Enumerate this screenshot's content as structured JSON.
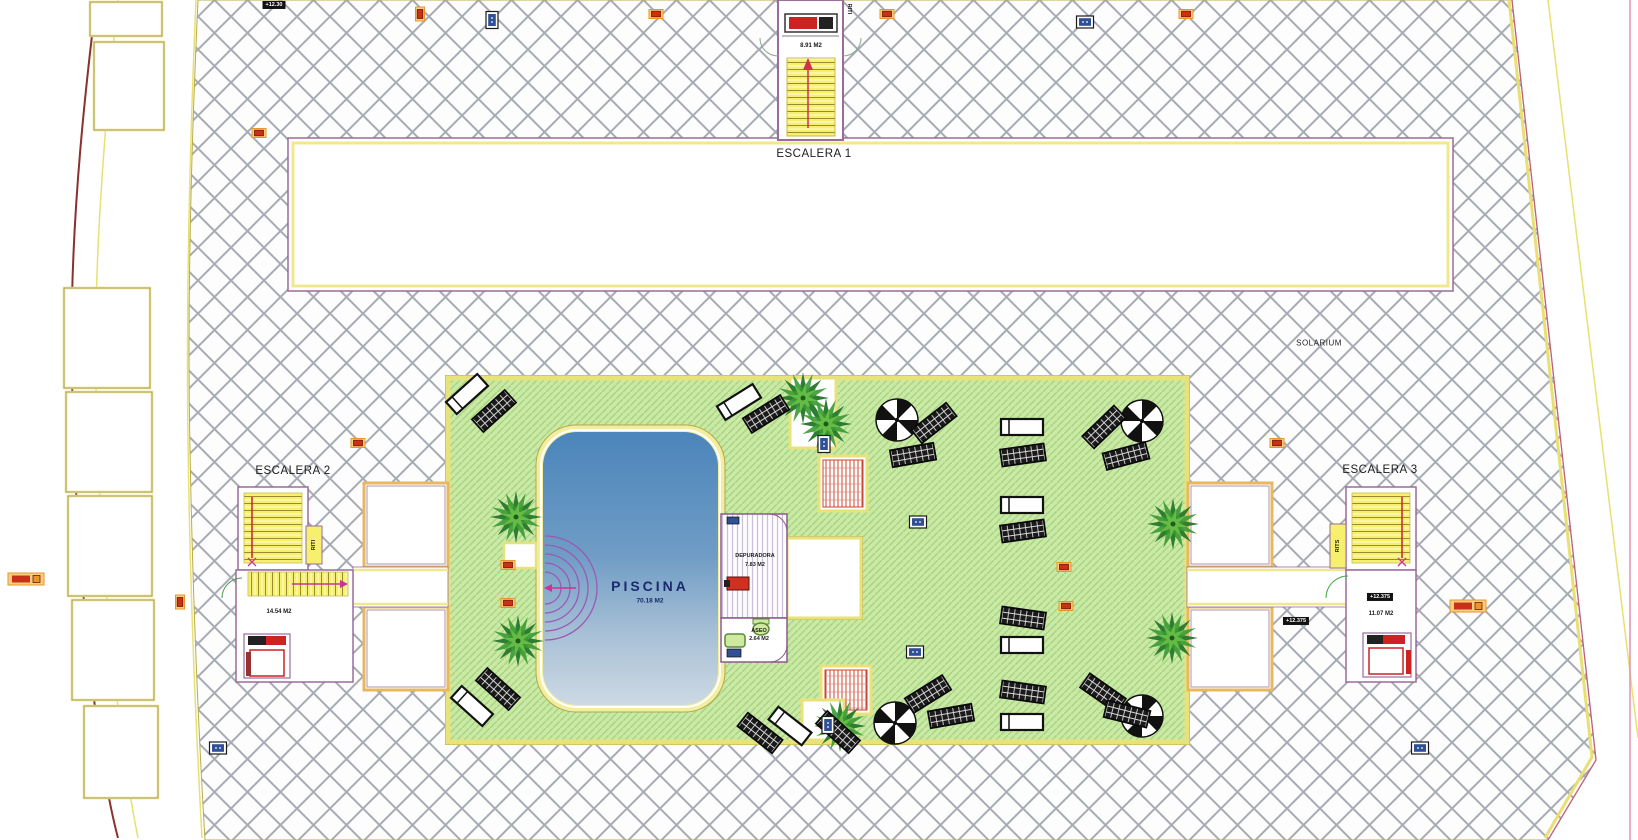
{
  "plan": {
    "rooms": {
      "escalera1": {
        "name": "ESCALERA 1",
        "area": "8.91 M2"
      },
      "escalera2": {
        "name": "ESCALERA 2",
        "area": "14.54 M2"
      },
      "escalera3": {
        "name": "ESCALERA 3",
        "area": "11.07 M2"
      },
      "piscina": {
        "name": "PISCINA",
        "area": "70.18 M2"
      },
      "depuradora": {
        "name": "DEPURADORA",
        "area": "7.83 M2"
      },
      "aseo": {
        "name": "ASEO",
        "area": "2.64 M2"
      },
      "solarium": {
        "name": "SOLARIUM"
      }
    },
    "riser_labels": {
      "top": "RITI",
      "escalera2": "RITI",
      "escalera3": "RITS"
    },
    "level_markers": {
      "top_left": "+12.30",
      "escalera3_landing": "+12.375",
      "escalera3_walkway": "+12.375"
    },
    "colors": {
      "paving_hatch_line": "#a7abb4",
      "lawn_green": "#cbe9a6",
      "lawn_stripe": "#a6d47f",
      "border_yellow": "#e8e27a",
      "wall_purple": "#9b6b9b",
      "stair_yellow": "#f7ef6e",
      "pool_deep": "#4b85bb",
      "pool_shallow": "#cdd9e4",
      "pool_text": "#1b2a70",
      "arrow_red": "#cc2222",
      "arrow_magenta": "#cc3399",
      "pergola_red": "#cc4433",
      "palm_dark": "#2e7d32",
      "palm_light": "#66bb44",
      "marker_orange": "#e8952a",
      "marker_red": "#c93018",
      "marker_blue": "#2f4f96"
    }
  }
}
